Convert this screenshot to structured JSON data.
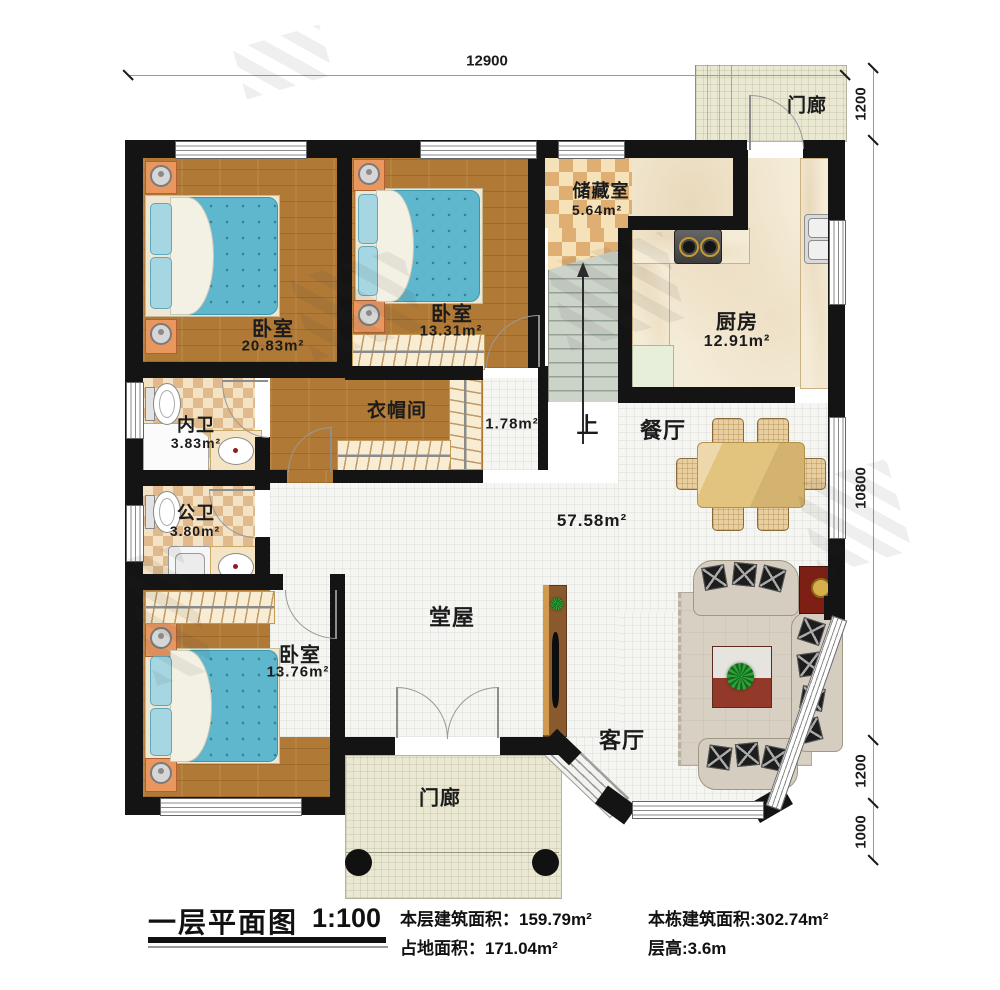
{
  "colors": {
    "wall": "#141414",
    "wood_floor": "#b07a36",
    "checker_tile": "#dfae72",
    "hall_tile": "#f5f5f2",
    "porch_tile": "#ebe8d2",
    "bed_blue": "#5fb7cd",
    "stairs_green": "#ccd3c9"
  },
  "rooms": {
    "bedroom1": {
      "name": "卧室",
      "area": "20.83m²"
    },
    "bedroom2": {
      "name": "卧室",
      "area": "13.31m²"
    },
    "bedroom3": {
      "name": "卧室",
      "area": "13.76m²"
    },
    "storage": {
      "name": "储藏室",
      "area": "5.64m²"
    },
    "kitchen": {
      "name": "厨房",
      "area": "12.91m²"
    },
    "bath_inner": {
      "name": "内卫",
      "area": "3.83m²"
    },
    "bath_public": {
      "name": "公卫",
      "area": "3.80m²"
    },
    "cloakroom": {
      "name": "衣帽间"
    },
    "stair_corner": {
      "area": "1.78m²"
    },
    "hall": {
      "name": "堂屋",
      "area": "57.58m²"
    },
    "dining": {
      "name": "餐厅"
    },
    "living": {
      "name": "客厅"
    },
    "porch_top": {
      "name": "门廊"
    },
    "porch_bottom": {
      "name": "门廊"
    },
    "stairs": {
      "up_label": "上"
    }
  },
  "dimensions": {
    "top": "12900",
    "right": [
      "1200",
      "10800",
      "1200",
      "1000"
    ]
  },
  "footer": {
    "title": "一层平面图",
    "scale": "1:100",
    "stats": [
      "本层建筑面积：159.79m²",
      "占地面积：171.04m²",
      "本栋建筑面积:302.74m²",
      "层高:3.6m"
    ]
  }
}
